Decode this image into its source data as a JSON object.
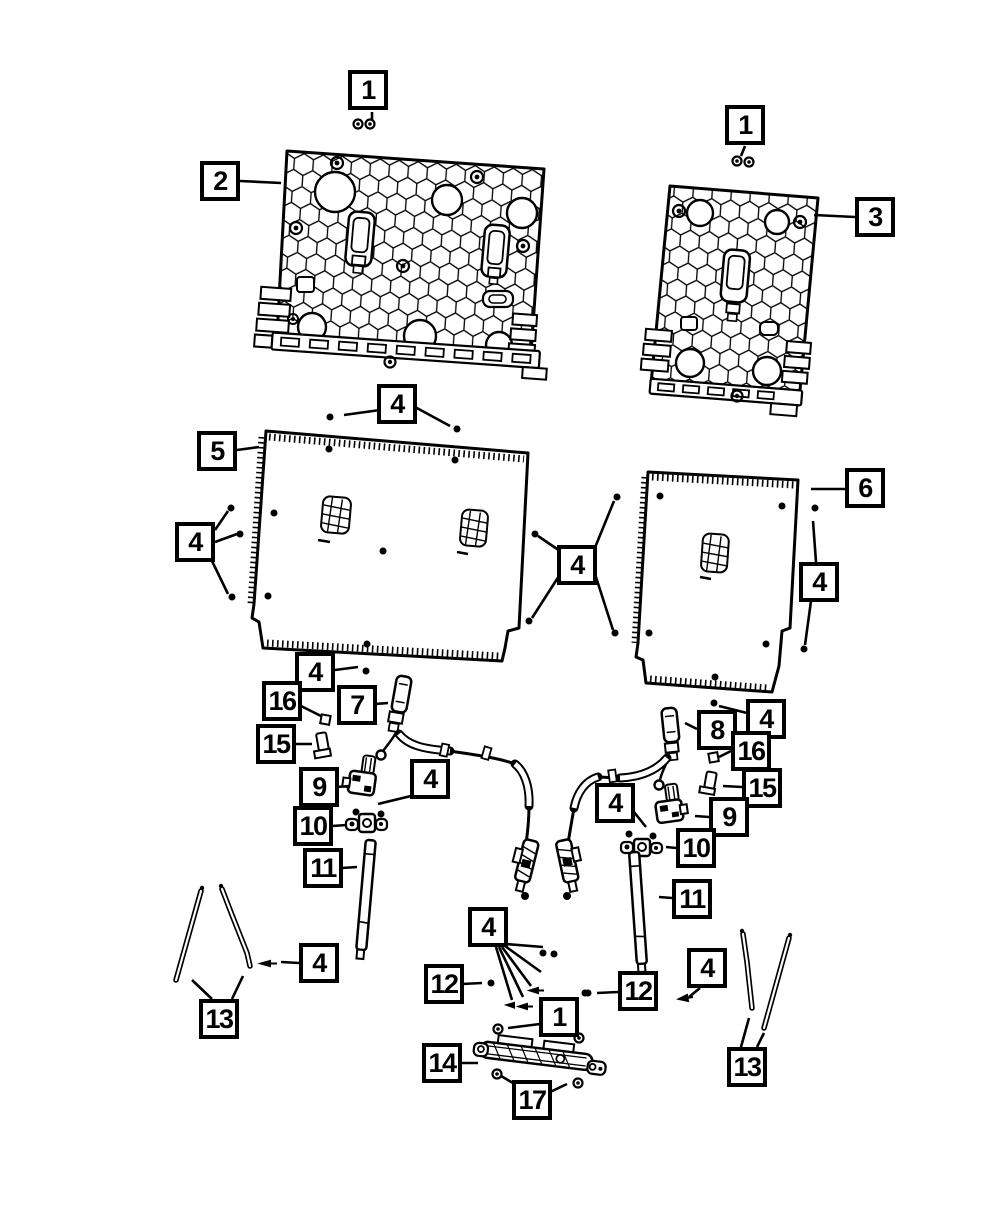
{
  "diagram": {
    "description": "Exploded parts diagram of rear seat back panels, frames, release cables, latch rods and fasteners",
    "style": {
      "line_color": "#000000",
      "background": "#ffffff",
      "callout_border": "#000000",
      "callout_background": "#ffffff",
      "callout_text": "#000000"
    }
  },
  "callouts": [
    {
      "label": "1",
      "x": 348,
      "y": 70
    },
    {
      "label": "2",
      "x": 200,
      "y": 161
    },
    {
      "label": "1",
      "x": 725,
      "y": 105
    },
    {
      "label": "3",
      "x": 855,
      "y": 197
    },
    {
      "label": "4",
      "x": 377,
      "y": 384
    },
    {
      "label": "5",
      "x": 197,
      "y": 431
    },
    {
      "label": "4",
      "x": 175,
      "y": 522
    },
    {
      "label": "4",
      "x": 557,
      "y": 545
    },
    {
      "label": "6",
      "x": 845,
      "y": 468
    },
    {
      "label": "4",
      "x": 799,
      "y": 562
    },
    {
      "label": "4",
      "x": 295,
      "y": 652
    },
    {
      "label": "16",
      "x": 262,
      "y": 681
    },
    {
      "label": "7",
      "x": 337,
      "y": 685
    },
    {
      "label": "15",
      "x": 256,
      "y": 724
    },
    {
      "label": "9",
      "x": 299,
      "y": 767
    },
    {
      "label": "4",
      "x": 410,
      "y": 759
    },
    {
      "label": "10",
      "x": 293,
      "y": 806
    },
    {
      "label": "11",
      "x": 303,
      "y": 848
    },
    {
      "label": "8",
      "x": 697,
      "y": 710
    },
    {
      "label": "4",
      "x": 746,
      "y": 699
    },
    {
      "label": "16",
      "x": 731,
      "y": 731
    },
    {
      "label": "15",
      "x": 742,
      "y": 768
    },
    {
      "label": "9",
      "x": 709,
      "y": 797
    },
    {
      "label": "4",
      "x": 595,
      "y": 783
    },
    {
      "label": "10",
      "x": 676,
      "y": 828
    },
    {
      "label": "11",
      "x": 672,
      "y": 879
    },
    {
      "label": "13",
      "x": 199,
      "y": 999
    },
    {
      "label": "4",
      "x": 299,
      "y": 943
    },
    {
      "label": "4",
      "x": 468,
      "y": 907
    },
    {
      "label": "12",
      "x": 424,
      "y": 964
    },
    {
      "label": "1",
      "x": 539,
      "y": 997
    },
    {
      "label": "12",
      "x": 618,
      "y": 971
    },
    {
      "label": "4",
      "x": 687,
      "y": 948
    },
    {
      "label": "14",
      "x": 422,
      "y": 1043
    },
    {
      "label": "17",
      "x": 512,
      "y": 1080
    },
    {
      "label": "13",
      "x": 727,
      "y": 1047
    }
  ]
}
